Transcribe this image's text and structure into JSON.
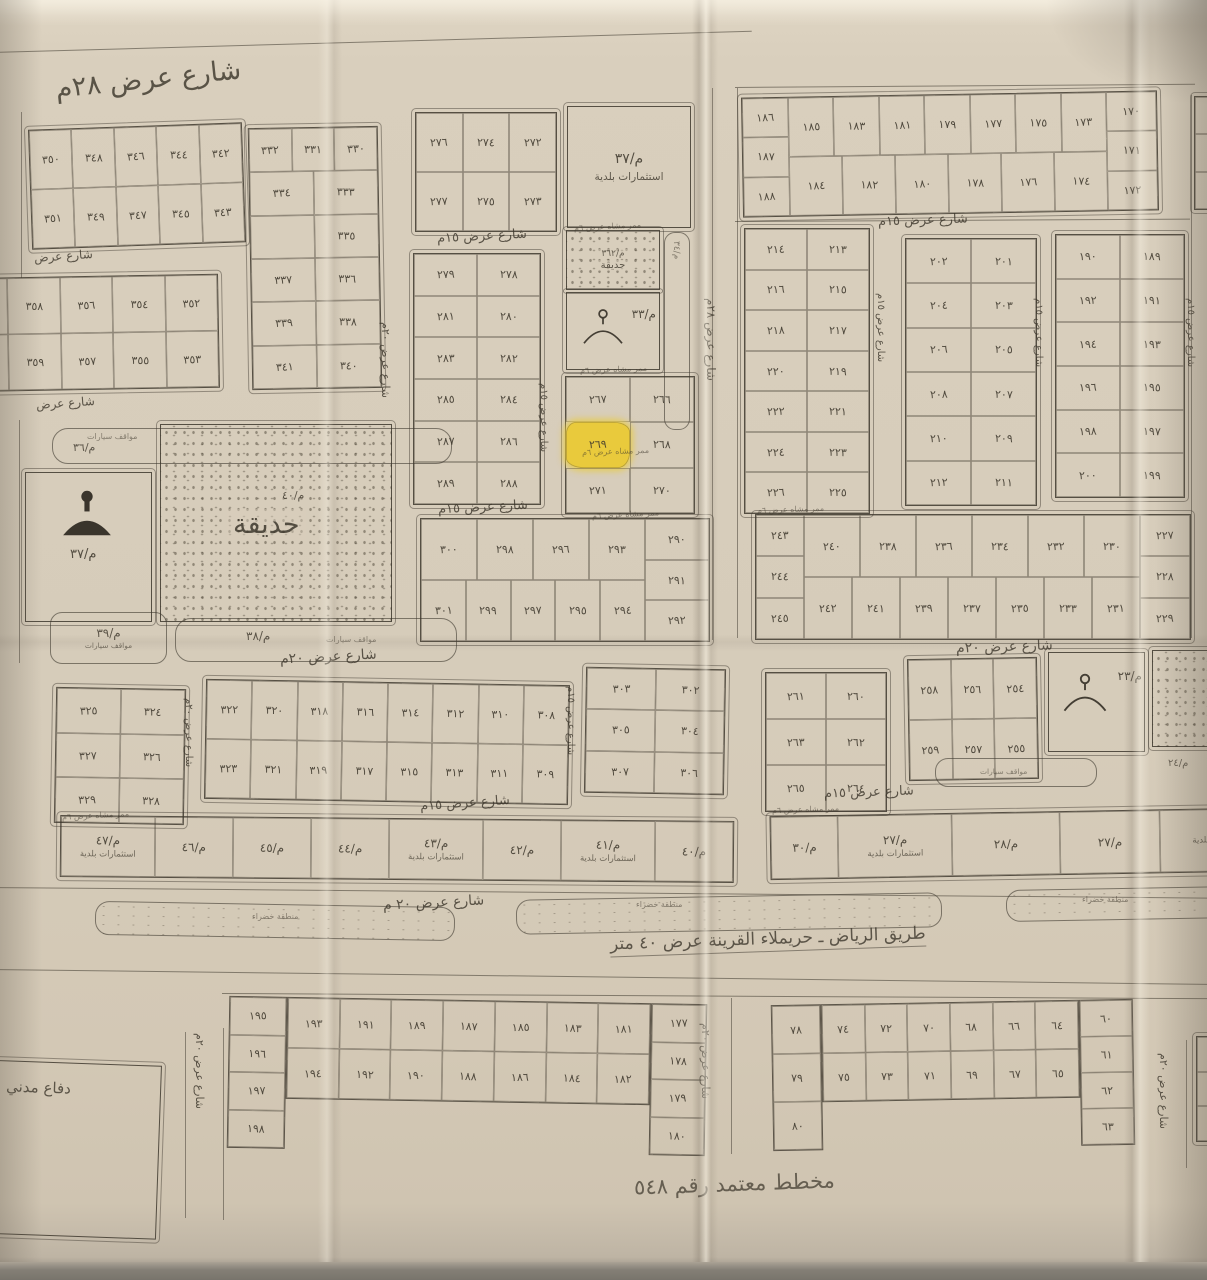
{
  "title": "مخطط معتمد رقم ٥٤٨",
  "road": {
    "label": "طريق الرياض ـ حريملاء القرينة عرض ٤٠ متر"
  },
  "highlighted_plot": "٢٦٩",
  "colors": {
    "paper": "#d8cebc",
    "ink": "#3e382d",
    "highlight": "#e9ca3c"
  },
  "green_zone_label": "منطقة خضراء",
  "path_label": "ممر مشاه عرض ٦م",
  "areas": {
    "invest_ne": {
      "code": "م/٣٧",
      "label": "استثمارات بلدية"
    },
    "garden_main": {
      "code": "م/٤٠",
      "label": "حديقة"
    },
    "garden_small": {
      "code": "م/٣٦٢",
      "label": "حديقة"
    },
    "mosque_west": {
      "code": "م/٣٧"
    },
    "mosque_center": {
      "code": "م/٣٣"
    },
    "mosque_se": {
      "code": "م/٢٣"
    },
    "parking_nw": {
      "code": "م/٣٦",
      "label": "مواقف سيارات"
    },
    "parking_sw": {
      "code": "م/٣٩",
      "label": "مواقف سيارات"
    },
    "parking_s": {
      "code": "م/٣٨",
      "label": "مواقف سيارات"
    },
    "parking_se": {
      "code": "م/٢٤",
      "label": "مواقف سيارات"
    },
    "strip_code_east": "م/٣٤",
    "defense": {
      "label": "دفاع مدني"
    }
  },
  "street_labels": [
    {
      "t": "شارع عرض ٢٨م",
      "x": 55,
      "y": 64,
      "fs": 27,
      "rot": -6
    },
    {
      "t": "شارع عرض ١٥م",
      "x": 437,
      "y": 229,
      "fs": 13,
      "rot": -3
    },
    {
      "t": "شارع عرض ١٥م",
      "x": 878,
      "y": 213,
      "fs": 13,
      "rot": -2
    },
    {
      "t": "شارع عرض ١٥م",
      "x": 438,
      "y": 500,
      "fs": 13,
      "rot": -3
    },
    {
      "t": "شارع عرض ٢٠م",
      "x": 280,
      "y": 649,
      "fs": 14,
      "rot": -3
    },
    {
      "t": "شارع عرض ٢٠م",
      "x": 956,
      "y": 639,
      "fs": 14,
      "rot": -2
    },
    {
      "t": "شارع عرض ١٥م",
      "x": 420,
      "y": 796,
      "fs": 13,
      "rot": -4
    },
    {
      "t": "شارع عرض ١٥م",
      "x": 824,
      "y": 785,
      "fs": 13,
      "rot": -2
    },
    {
      "t": "شارع عرض ٢٠ م",
      "x": 383,
      "y": 895,
      "fs": 14,
      "rot": -3
    },
    {
      "t": "شارع عرض",
      "x": 34,
      "y": 249,
      "fs": 12,
      "rot": -4
    },
    {
      "t": "شارع عرض",
      "x": 36,
      "y": 396,
      "fs": 12,
      "rot": -4
    },
    {
      "t": "شارع عرض ٢٠م",
      "x": 392,
      "y": 322,
      "fs": 11,
      "vert": true
    },
    {
      "t": "شارع عرض ١٥م",
      "x": 549,
      "y": 383,
      "fs": 10,
      "vert": true
    },
    {
      "t": "شارع عرض ٢٨م",
      "x": 718,
      "y": 298,
      "fs": 12,
      "vert": true
    },
    {
      "t": "شارع عرض ١٥م",
      "x": 886,
      "y": 293,
      "fs": 10,
      "vert": true
    },
    {
      "t": "شارع عرض ١٥م",
      "x": 1044,
      "y": 298,
      "fs": 10,
      "vert": true
    },
    {
      "t": "شارع عرض ١٥م",
      "x": 1196,
      "y": 298,
      "fs": 10,
      "vert": true
    },
    {
      "t": "شارع عرض ٢٠م",
      "x": 194,
      "y": 698,
      "fs": 10,
      "vert": true
    },
    {
      "t": "شارع عرض ١٥م",
      "x": 576,
      "y": 686,
      "fs": 10,
      "vert": true
    },
    {
      "t": "شارع عرض ٢٠م",
      "x": 206,
      "y": 1033,
      "fs": 11,
      "vert": true
    },
    {
      "t": "شارع عرض ٢٠م",
      "x": 712,
      "y": 1023,
      "fs": 11,
      "vert": true
    },
    {
      "t": "شارع عرض ٢٠م",
      "x": 1170,
      "y": 1053,
      "fs": 11,
      "vert": true
    }
  ],
  "path_labels": [
    {
      "x": 574,
      "y": 222,
      "rot": -3
    },
    {
      "x": 580,
      "y": 365,
      "rot": -2
    },
    {
      "x": 582,
      "y": 447,
      "rot": -2
    },
    {
      "x": 592,
      "y": 510,
      "rot": -3
    },
    {
      "x": 757,
      "y": 505,
      "rot": -2
    },
    {
      "x": 62,
      "y": 811,
      "rot": -3
    },
    {
      "x": 772,
      "y": 805,
      "rot": -2
    }
  ],
  "green_labels": [
    {
      "x": 252,
      "y": 912
    },
    {
      "x": 636,
      "y": 900
    },
    {
      "x": 1082,
      "y": 895
    }
  ],
  "blocks": [
    {
      "id": "nw-a",
      "x": 30,
      "y": 126,
      "w": 212,
      "h": 118,
      "rot": -2,
      "rows": [
        [
          "٣٥٠",
          "٣٤٨",
          "٣٤٦",
          "٣٤٤",
          "٣٤٢"
        ],
        [
          "٣٥١",
          "٣٤٩",
          "٣٤٧",
          "٣٤٥",
          "٣٤٣"
        ]
      ]
    },
    {
      "id": "nw-b",
      "x": 250,
      "y": 127,
      "w": 128,
      "h": 260,
      "rot": -1,
      "rows": [
        [
          "٣٣٢",
          "٣٣١",
          "٣٣٠"
        ],
        [
          "٣٣٤",
          "٣٣٣"
        ],
        [
          "",
          "٣٣٥"
        ],
        [
          "٣٣٧",
          "٣٣٦"
        ],
        [
          "٣٣٩",
          "٣٣٨"
        ],
        [
          "٣٤١",
          "٣٤٠"
        ]
      ]
    },
    {
      "id": "nw-z",
      "x": -45,
      "y": 276,
      "w": 262,
      "h": 112,
      "rot": -1,
      "rows": [
        [
          "٣٦٠",
          "٣٥٨",
          "٣٥٦",
          "٣٥٤",
          "٣٥٢"
        ],
        [
          "٣٦١",
          "٣٥٩",
          "٣٥٧",
          "٣٥٥",
          "٣٥٣"
        ]
      ]
    },
    {
      "id": "n-c",
      "x": 415,
      "y": 112,
      "w": 140,
      "h": 118,
      "rot": 0,
      "rows": [
        [
          "٢٧٦",
          "٢٧٤",
          "٢٧٢"
        ],
        [
          "٢٧٧",
          "٢٧٥",
          "٢٧٣"
        ]
      ]
    },
    {
      "id": "n-e",
      "x": 413,
      "y": 253,
      "w": 126,
      "h": 250,
      "rot": 0,
      "rows": [
        [
          "٢٧٩",
          "٢٧٨"
        ],
        [
          "٢٨١",
          "٢٨٠"
        ],
        [
          "٢٨٣",
          "٢٨٢"
        ],
        [
          "٢٨٥",
          "٢٨٤"
        ],
        [
          "٢٨٧",
          "٢٨٦"
        ],
        [
          "٢٨٩",
          "٢٨٨"
        ]
      ]
    },
    {
      "id": "n-f",
      "x": 565,
      "y": 376,
      "w": 128,
      "h": 136,
      "rot": 0,
      "highlight": "٢٦٩",
      "rows": [
        [
          "٢٦٧",
          "٢٦٦"
        ],
        [
          "٢٦٩",
          "٢٦٨"
        ],
        [
          "٢٧١",
          "٢٧٠"
        ]
      ]
    },
    {
      "id": "c-g",
      "x": 420,
      "y": 518,
      "w": 288,
      "h": 122,
      "rot": 0,
      "right": [
        "٢٩٠",
        "٢٩١",
        "٢٩٢"
      ],
      "rightW": 64,
      "rows": [
        [
          "٣٠٠",
          "٢٩٨",
          "٢٩٦",
          "٢٩٣"
        ],
        [
          "٣٠١",
          "٢٩٩",
          "٢٩٧",
          "٢٩٥",
          "٢٩٤"
        ]
      ]
    },
    {
      "id": "ne-h",
      "x": 742,
      "y": 94,
      "w": 414,
      "h": 118,
      "rot": -1,
      "left": [
        "١٨٦",
        "١٨٧",
        "١٨٨"
      ],
      "leftW": 46,
      "right": [
        "١٧٠",
        "١٧١",
        "١٧٢"
      ],
      "rightW": 50,
      "rows": [
        [
          "١٨٥",
          "١٨٣",
          "١٨١",
          "١٧٩",
          "١٧٧",
          "١٧٥",
          "١٧٣"
        ],
        [
          "١٨٤",
          "١٨٢",
          "١٨٠",
          "١٧٨",
          "١٧٦",
          "١٧٤"
        ]
      ]
    },
    {
      "id": "e-i",
      "x": 744,
      "y": 228,
      "w": 124,
      "h": 284,
      "rot": 0,
      "rows": [
        [
          "٢١٤",
          "٢١٣"
        ],
        [
          "٢١٦",
          "٢١٥"
        ],
        [
          "٢١٨",
          "٢١٧"
        ],
        [
          "٢٢٠",
          "٢١٩"
        ],
        [
          "٢٢٢",
          "٢٢١"
        ],
        [
          "٢٢٤",
          "٢٢٣"
        ],
        [
          "٢٢٦",
          "٢٢٥"
        ]
      ]
    },
    {
      "id": "e-j",
      "x": 905,
      "y": 238,
      "w": 130,
      "h": 266,
      "rot": 0,
      "rows": [
        [
          "٢٠٢",
          "٢٠١"
        ],
        [
          "٢٠٤",
          "٢٠٣"
        ],
        [
          "٢٠٦",
          "٢٠٥"
        ],
        [
          "٢٠٨",
          "٢٠٧"
        ],
        [
          "٢١٠",
          "٢٠٩"
        ],
        [
          "٢١٢",
          "٢١١"
        ]
      ]
    },
    {
      "id": "e-k",
      "x": 1055,
      "y": 234,
      "w": 128,
      "h": 262,
      "rot": 0,
      "rows": [
        [
          "١٩٠",
          "١٨٩"
        ],
        [
          "١٩٢",
          "١٩١"
        ],
        [
          "١٩٤",
          "١٩٣"
        ],
        [
          "١٩٦",
          "١٩٥"
        ],
        [
          "١٩٨",
          "١٩٧"
        ],
        [
          "٢٠٠",
          "١٩٩"
        ]
      ]
    },
    {
      "id": "e-l",
      "x": 755,
      "y": 514,
      "w": 434,
      "h": 124,
      "rot": 0,
      "left": [
        "٢٤٣",
        "٢٤٤",
        "٢٤٥"
      ],
      "leftW": 48,
      "right": [
        "٢٢٧",
        "٢٢٨",
        "٢٢٩"
      ],
      "rightW": 50,
      "rows": [
        [
          "٢٤٠",
          "٢٣٨",
          "٢٣٦",
          "٢٣٤",
          "٢٣٢",
          "٢٣٠"
        ],
        [
          "٢٤٢",
          "٢٤١",
          "٢٣٩",
          "٢٣٧",
          "٢٣٥",
          "٢٣٣",
          "٢٣١"
        ]
      ]
    },
    {
      "id": "sw-m",
      "x": 55,
      "y": 688,
      "w": 128,
      "h": 134,
      "rot": 1,
      "rows": [
        [
          "٣٢٥",
          "٣٢٤"
        ],
        [
          "٣٢٧",
          "٣٢٦"
        ],
        [
          "٣٢٩",
          "٣٢٨"
        ]
      ]
    },
    {
      "id": "sw-n",
      "x": 205,
      "y": 682,
      "w": 362,
      "h": 118,
      "rot": 1,
      "rows": [
        [
          "٣٢٢",
          "٣٢٠",
          "٣١٨",
          "٣١٦",
          "٣١٤",
          "٣١٢",
          "٣١٠",
          "٣٠٨"
        ],
        [
          "٣٢٣",
          "٣٢١",
          "٣١٩",
          "٣١٧",
          "٣١٥",
          "٣١٣",
          "٣١١",
          "٣٠٩"
        ]
      ]
    },
    {
      "id": "sw-o",
      "x": 585,
      "y": 668,
      "w": 138,
      "h": 124,
      "rot": 1,
      "rows": [
        [
          "٣٠٣",
          "٣٠٢"
        ],
        [
          "٣٠٥",
          "٣٠٤"
        ],
        [
          "٣٠٧",
          "٣٠٦"
        ]
      ]
    },
    {
      "id": "se-q",
      "x": 765,
      "y": 672,
      "w": 120,
      "h": 138,
      "rot": 0,
      "rows": [
        [
          "٢٦١",
          "٢٦٠"
        ],
        [
          "٢٦٣",
          "٢٦٢"
        ],
        [
          "٢٦٥",
          "٢٦٤"
        ]
      ]
    },
    {
      "id": "se-r",
      "x": 908,
      "y": 658,
      "w": 128,
      "h": 120,
      "rot": -1,
      "rows": [
        [
          "٢٥٨",
          "٢٥٦",
          "٢٥٤"
        ],
        [
          "٢٥٩",
          "٢٥٧",
          "٢٥٥"
        ]
      ]
    },
    {
      "id": "s-v",
      "x": 228,
      "y": 1000,
      "w": 478,
      "h": 152,
      "rot": 1,
      "open": true,
      "ch": 100,
      "left": [
        "١٩٥",
        "١٩٦",
        "١٩٧",
        "١٩٨"
      ],
      "leftW": 56,
      "right": [
        "١٧٧",
        "١٧٨",
        "١٧٩",
        "١٨٠"
      ],
      "rightW": 54,
      "rows": [
        [
          "١٩٣",
          "١٩١",
          "١٨٩",
          "١٨٧",
          "١٨٥",
          "١٨٣",
          "١٨١"
        ],
        [
          "١٩٤",
          "١٩٢",
          "١٩٠",
          "١٨٨",
          "١٨٦",
          "١٨٤",
          "١٨٢"
        ]
      ]
    },
    {
      "id": "s-w",
      "x": 772,
      "y": 1002,
      "w": 362,
      "h": 146,
      "rot": -1,
      "open": true,
      "ch": 96,
      "left": [
        "٧٨",
        "٧٩",
        "٨٠"
      ],
      "leftW": 48,
      "right": [
        "٦٠",
        "٦١",
        "٦٢",
        "٦٣"
      ],
      "rightW": 52,
      "rows": [
        [
          "٧٤",
          "٧٢",
          "٧٠",
          "٦٨",
          "٦٦",
          "٦٤"
        ],
        [
          "٧٥",
          "٧٣",
          "٧١",
          "٦٩",
          "٦٧",
          "٦٥"
        ]
      ]
    },
    {
      "id": "edge-ne",
      "x": 1194,
      "y": 96,
      "w": 42,
      "h": 112,
      "rot": 0,
      "rows": [
        [
          ""
        ],
        [
          ""
        ],
        [
          ""
        ]
      ]
    },
    {
      "id": "edge-se",
      "x": 1196,
      "y": 1036,
      "w": 40,
      "h": 104,
      "rot": 0,
      "rows": [
        [
          ""
        ],
        [
          ""
        ],
        [
          ""
        ]
      ]
    }
  ],
  "strips": [
    {
      "id": "invest-sw",
      "x": 60,
      "y": 818,
      "w": 672,
      "h": 60,
      "rot": 0.5,
      "cells": [
        {
          "c": "م/٤٧",
          "sub": "استثمارات بلدية",
          "f": 1.2
        },
        {
          "c": "م/٤٦",
          "f": 1
        },
        {
          "c": "م/٤٥",
          "f": 1
        },
        {
          "c": "م/٤٤",
          "f": 1
        },
        {
          "c": "م/٤٣",
          "sub": "استثمارات بلدية",
          "f": 1.2
        },
        {
          "c": "م/٤٢",
          "f": 1
        },
        {
          "c": "م/٤١",
          "sub": "استثمارات بلدية",
          "f": 1.2
        },
        {
          "c": "م/٤٠",
          "f": 1
        }
      ]
    },
    {
      "id": "invest-se",
      "x": 770,
      "y": 812,
      "w": 470,
      "h": 62,
      "rot": -1,
      "cells": [
        {
          "c": "م/٣٠",
          "f": 1
        },
        {
          "c": "م/٢٧",
          "sub": "استثمارات بلدية",
          "f": 1.7
        },
        {
          "c": "م/٢٨",
          "f": 1.6
        },
        {
          "c": "م/٢٧",
          "f": 1.5
        },
        {
          "c": "",
          "sub": "بلدية",
          "f": 1.2
        }
      ]
    }
  ],
  "decor": {
    "hlines": [
      {
        "x": -8,
        "y": 52,
        "w": 760,
        "rot": -1.6
      },
      {
        "x": 735,
        "y": 87,
        "w": 460,
        "rot": -0.4
      },
      {
        "x": 735,
        "y": 221,
        "w": 455,
        "rot": -0.3
      },
      {
        "x": -8,
        "y": 887,
        "w": 1225,
        "rot": 0.5
      },
      {
        "x": -8,
        "y": 969,
        "w": 1225,
        "rot": 0.7
      },
      {
        "x": 222,
        "y": 993,
        "w": 1000,
        "rot": 0.3
      }
    ],
    "vlines": [
      {
        "x": 712,
        "y": 88,
        "h": 552
      },
      {
        "x": 737,
        "y": 88,
        "h": 550
      },
      {
        "x": 1191,
        "y": 95,
        "h": 543
      },
      {
        "x": 21,
        "y": 112,
        "h": 166
      },
      {
        "x": 19,
        "y": 420,
        "h": 243
      },
      {
        "x": 185,
        "y": 1032,
        "h": 186
      },
      {
        "x": 223,
        "y": 1028,
        "h": 192
      },
      {
        "x": 731,
        "y": 998,
        "h": 156
      },
      {
        "x": 1186,
        "y": 1040,
        "h": 128
      }
    ],
    "medians": [
      {
        "x": 95,
        "y": 904,
        "w": 358,
        "h": 32,
        "rot": 1
      },
      {
        "x": 516,
        "y": 896,
        "w": 424,
        "h": 33,
        "rot": -1
      },
      {
        "x": 1006,
        "y": 888,
        "w": 225,
        "h": 30,
        "rot": -1
      }
    ]
  }
}
